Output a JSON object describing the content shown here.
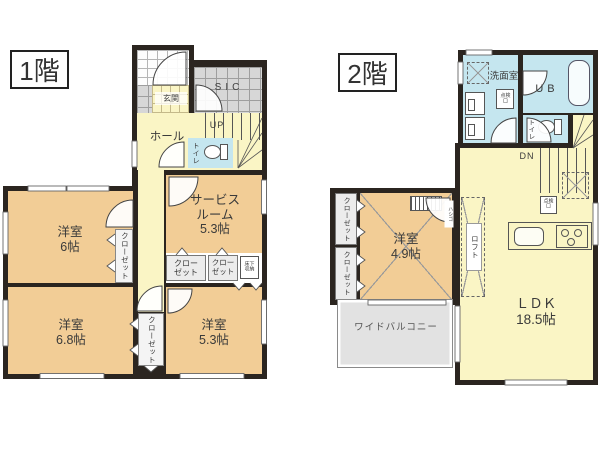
{
  "colors": {
    "wall": "#2b2520",
    "room-tan": "#f2cd96",
    "room-yellow": "#faf5c5",
    "room-blue": "#c5e6ef",
    "text": "#3a3a3a"
  },
  "floor1": {
    "title": "1階",
    "entrance_label": "玄関",
    "sic_label": "SIC",
    "hall_label": "ホール",
    "up_label": "UP",
    "toilet_label": "トイレ",
    "service_room_label": "サービス\nルーム\n5.3帖",
    "bedroom6_label": "洋室\n6帖",
    "bedroom68_label": "洋室\n6.8帖",
    "bedroom53_label": "洋室\n5.3帖",
    "closet_vertical1_label": "クローゼット",
    "closet_vertical2_label": "クローゼット",
    "closet_a_label": "クロー\nゼット",
    "closet_b_label": "クロー\nゼット",
    "underfloor_label": "床下\n収納"
  },
  "floor2": {
    "title": "2階",
    "washroom_label": "洗面室",
    "ub_label": "UB",
    "toilet_label": "トイレ",
    "dn_label": "DN",
    "hatch1_label": "点検\n口",
    "hatch2_label": "点検\n口",
    "bedroom49_label": "洋室\n4.9帖",
    "closet1_label": "クローゼット",
    "closet2_label": "クローゼット",
    "loft_label": "ロフト",
    "ladder_label": "ハシゴ",
    "balcony_label": "ワイドバルコニー",
    "ldk_label": "ＬＤＫ\n18.5帖"
  }
}
